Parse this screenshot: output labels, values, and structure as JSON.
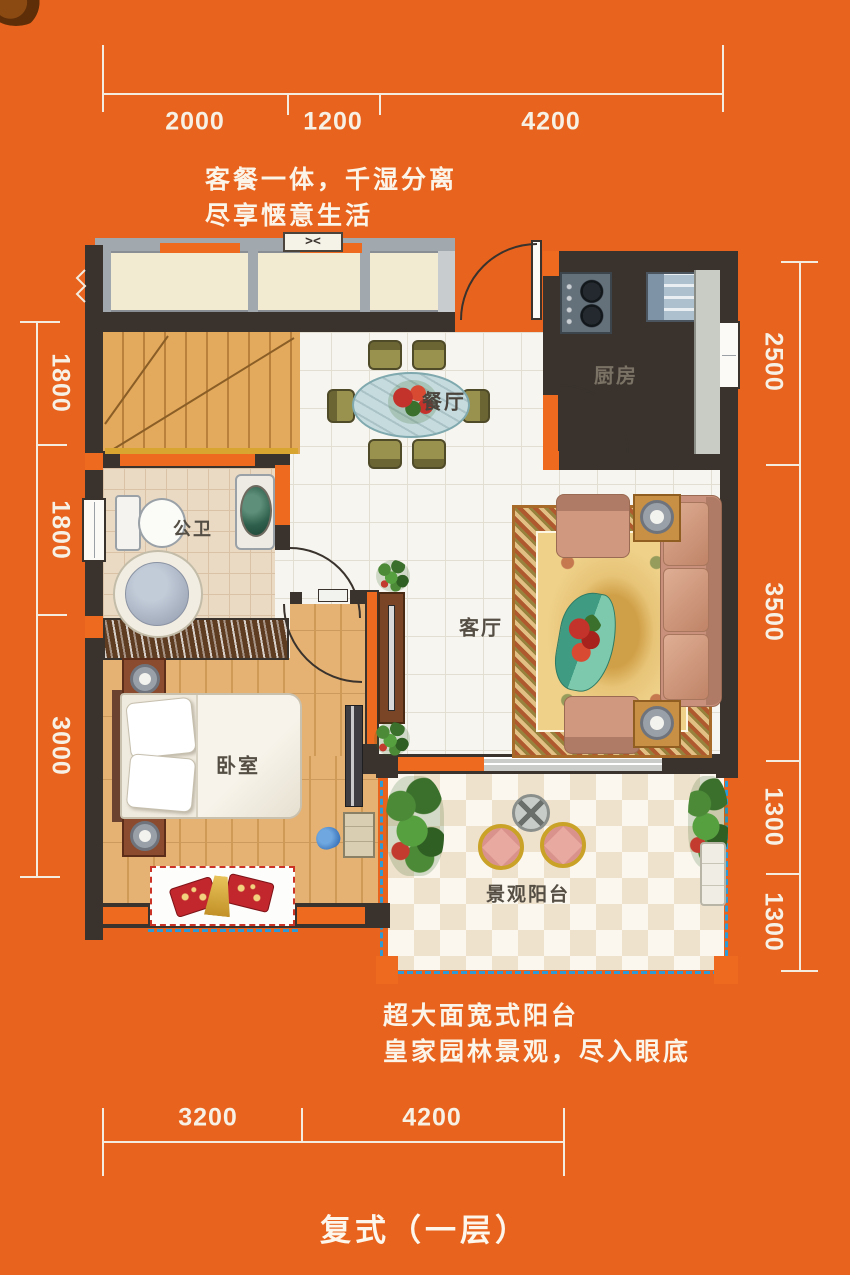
{
  "title": "复式（一层）",
  "marketing_text": {
    "top_line1": "客餐一体，千湿分离",
    "top_line2": "尽享惬意生活",
    "bottom_line1": "超大面宽式阳台",
    "bottom_line2": "皇家园林景观，尽入眼底"
  },
  "room_labels": {
    "dining": "餐厅",
    "kitchen": "厨房",
    "bathroom": "公卫",
    "living": "客厅",
    "bedroom": "卧室",
    "balcony": "景观阳台"
  },
  "dims": {
    "top": [
      "2000",
      "1200",
      "4200"
    ],
    "bottom": [
      "3200",
      "4200"
    ],
    "left": [
      "1800",
      "1800",
      "3000"
    ],
    "right": [
      "2500",
      "3500",
      "1300",
      "1300"
    ]
  },
  "symbols": {
    "window_vent": "><"
  },
  "colors": {
    "background": "#E8641E",
    "wall_dark": "#39322D",
    "wall_accent": "#EE6A1F",
    "balcony_dashed_edge": "#2E9BD6",
    "dimension_text": "#F7F0E5",
    "bay_window_dashed": "#CC3327"
  }
}
